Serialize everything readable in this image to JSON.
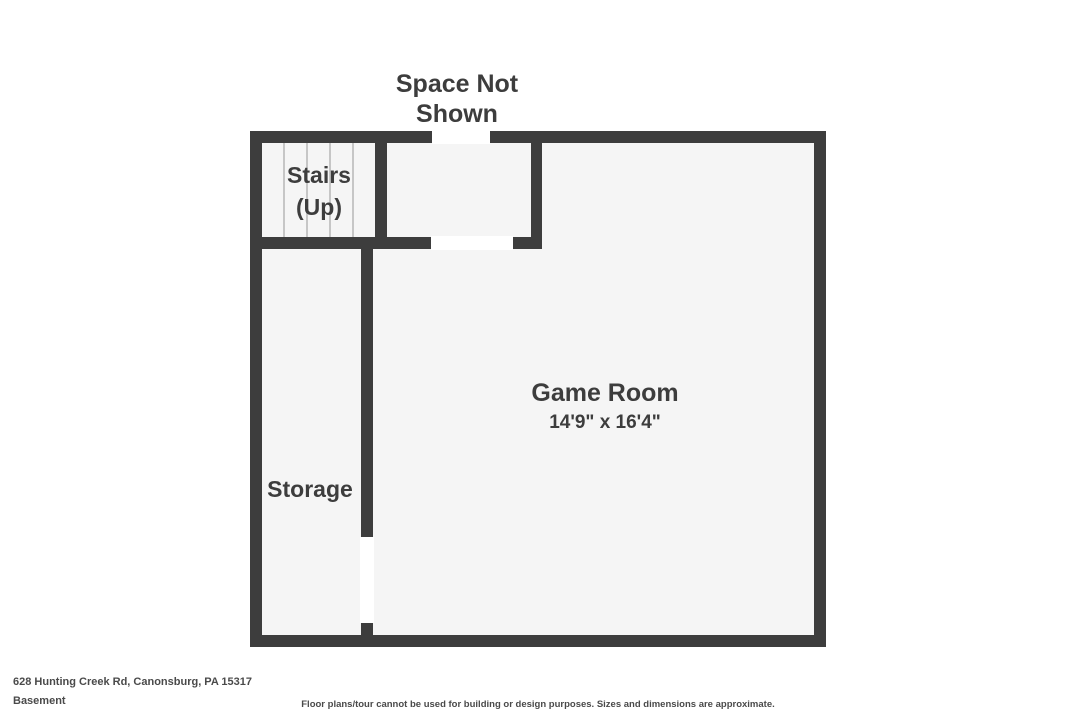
{
  "plan": {
    "space_label": {
      "line1": "Space Not",
      "line2": "Shown"
    },
    "rooms": {
      "stairs": {
        "line1": "Stairs",
        "line2": "(Up)"
      },
      "storage": {
        "name": "Storage"
      },
      "game_room": {
        "name": "Game Room",
        "dimensions": "14'9\" x 16'4\""
      }
    }
  },
  "footer": {
    "address": "628 Hunting Creek Rd, Canonsburg, PA 15317",
    "level": "Basement",
    "disclaimer": "Floor plans/tour cannot be used for building or design purposes. Sizes and dimensions are approximate."
  },
  "colors": {
    "wall": "#3d3d3d",
    "room_fill": "#f5f5f5",
    "stair_tread": "#c6c6c6",
    "label_text": "#3d3d3d",
    "footer_text": "#4a4a4a"
  }
}
